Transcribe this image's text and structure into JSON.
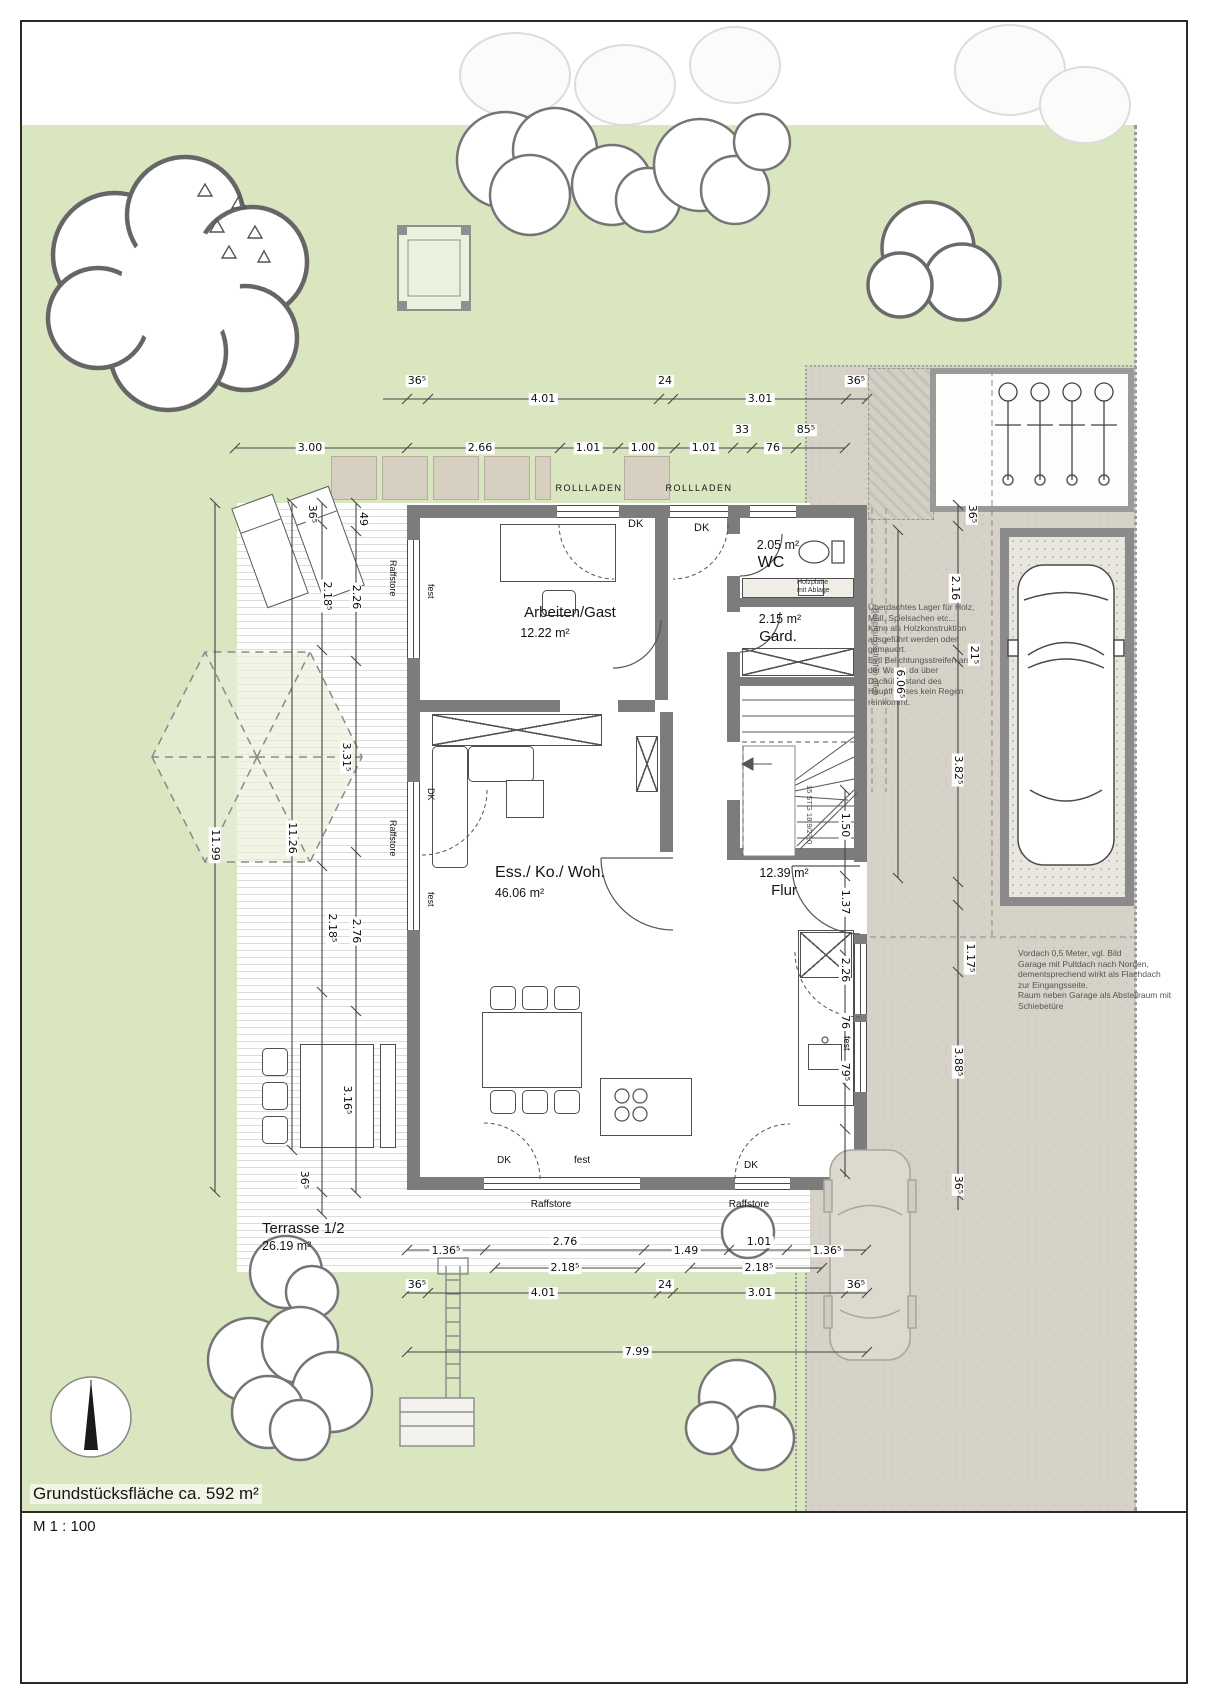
{
  "title_block": {
    "site_area": "Grundstücksfläche ca. 592 m²",
    "scale": "M 1 : 100"
  },
  "rooms": [
    {
      "name": "Arbeiten/Gast",
      "area": "12.22 m²"
    },
    {
      "name": "WC",
      "area": "2.05 m²"
    },
    {
      "name": "Gard.",
      "area": "2.15 m²"
    },
    {
      "name": "Ess./ Ko./ Woh.",
      "area": "46.06 m²"
    },
    {
      "name": "Flur",
      "area": "12.39 m²"
    },
    {
      "name": "Terrasse 1/2",
      "area": "26.19 m²"
    }
  ],
  "labels": {
    "rollladen": "ROLLLADEN",
    "raffstore": "Raffstore",
    "dk": "DK",
    "fest": "fest",
    "stair": "15 STG 18,9/27,0",
    "wc_shelf": [
      "Holzplatte",
      "mit Ablage"
    ],
    "light_strip": "Belichtungsstreifen offen"
  },
  "notes": {
    "storage": [
      "Überdachtes Lager für Holz,",
      "Müll, Spielsachen etc...",
      "Kann als Holzkonstruktion",
      "ausgeführt werden oder",
      "gemauert.",
      "Evtl Belichtungsstreifen an",
      "der Wand, da über",
      "Dachüberstand des",
      "Haupthauses kein Regen",
      "reinkommt."
    ],
    "garage": [
      "Vordach 0,5 Meter, vgl. Bild",
      "Garage mit Pultdach nach Norden,",
      "dementsprechend wirkt als Flachdach",
      "zur Eingangsseite.",
      "Raum neben Garage als Abstellraum mit",
      "Schiebetüre"
    ]
  },
  "dimensions": {
    "top_row1": [
      "36⁵",
      "4.01",
      "24",
      "3.01",
      "36⁵"
    ],
    "top_row2": [
      "3.00",
      "2.66",
      "1.01",
      "1.00",
      "1.01",
      "33",
      "76",
      "85⁵"
    ],
    "bottom_row1": [
      "1.36⁵",
      "2.76",
      "1.49",
      "1.01",
      "1.36⁵"
    ],
    "bottom_row2": [
      "2.18⁵",
      "2.18⁵"
    ],
    "bottom_row3": [
      "36⁵",
      "4.01",
      "24",
      "3.01",
      "36⁵"
    ],
    "bottom_total": "7.99",
    "left_outer": "11.99",
    "left_inner": "11.26",
    "left_chain1": [
      "36⁵",
      "2.18⁵",
      "2.18⁵",
      "36⁵"
    ],
    "left_chain2": [
      "49",
      "2.26",
      "3.31⁵",
      "2.76",
      "3.16⁵"
    ],
    "right_outer": [
      "36⁵",
      "2.16",
      "21⁵",
      "3.82⁵",
      "1.17⁵",
      "3.88⁵",
      "36⁵"
    ],
    "right_inner": [
      "1.50",
      "1.37",
      "2.26",
      "76",
      "79⁵"
    ],
    "right_mid": "6.06⁵"
  },
  "colors": {
    "lawn": "#d9e6c0",
    "paving": "#d6d2c8",
    "wall": "#7c7c7c",
    "deck_line": "#dcdcdc",
    "hexagon_fill": "#e8f0d9"
  }
}
